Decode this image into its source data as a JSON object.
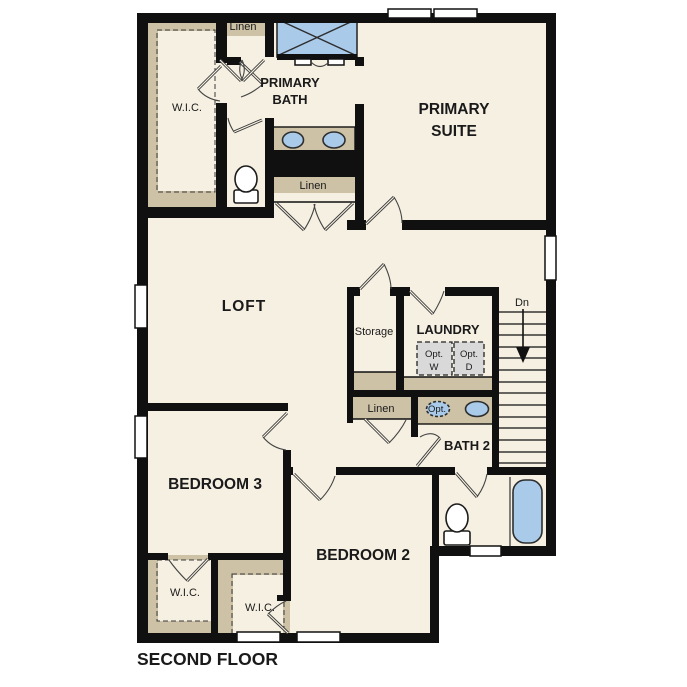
{
  "colors": {
    "floor": "#f6f0e2",
    "wall": "#101010",
    "tan": "#cdc1a6",
    "blue": "#a9cae9",
    "gray": "#d9d9d9",
    "ink": "#1a1a1a",
    "outside": "#ffffff"
  },
  "labels": {
    "floor_title": "SECOND FLOOR",
    "primary_suite_1": "PRIMARY",
    "primary_suite_2": "SUITE",
    "primary_bath_1": "PRIMARY",
    "primary_bath_2": "BATH",
    "loft": "LOFT",
    "bedroom3": "BEDROOM 3",
    "bedroom2": "BEDROOM 2",
    "bath2": "BATH 2",
    "laundry": "LAUNDRY",
    "storage": "Storage",
    "wic_primary": "W.I.C.",
    "wic_bed3": "W.I.C.",
    "wic_bed2": "W.I.C.",
    "linen_top": "Linen",
    "linen_hall": "Linen",
    "linen_bath": "Linen",
    "opt_washer_1": "Opt.",
    "opt_washer_2": "W",
    "opt_dryer_1": "Opt.",
    "opt_dryer_2": "D",
    "opt_sink": "Opt.",
    "stairs_down": "Dn"
  }
}
